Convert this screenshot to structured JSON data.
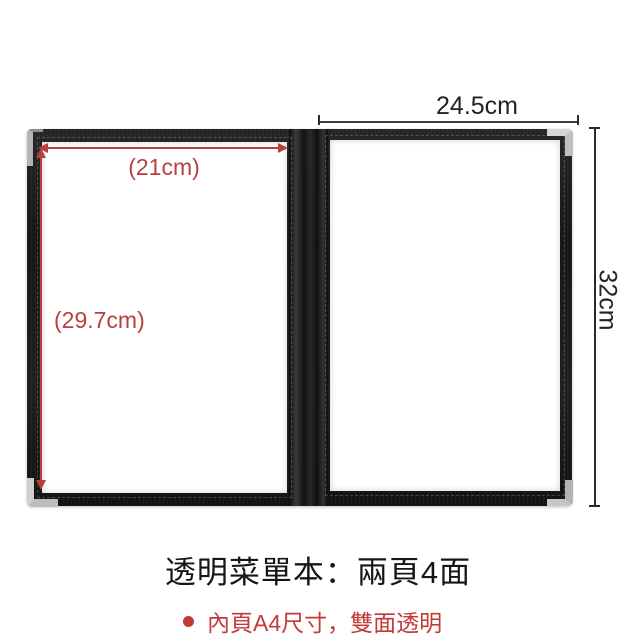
{
  "figure": {
    "type": "product-photo",
    "subject": "black transparent menu folder opened flat, two pages with metal corner protectors"
  },
  "annotations": {
    "inner_width_label": "(21cm)",
    "inner_height_label": "(29.7cm)",
    "outer_width_label": "24.5cm",
    "outer_height_label": "32cm"
  },
  "caption": {
    "title": "透明菜單本：兩頁4面",
    "bullet_text": "內頁A4尺寸，雙面透明"
  },
  "colors": {
    "annotation_red": "#b8403d",
    "caption_red": "#c43a38",
    "dimension_black": "#2a2a2a",
    "folder_black": "#1b1b1b"
  }
}
